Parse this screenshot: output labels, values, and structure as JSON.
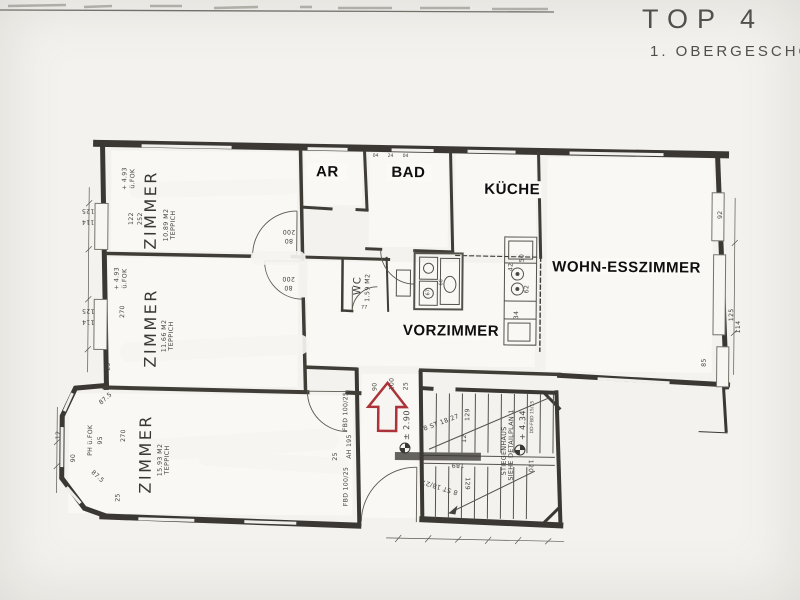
{
  "title": {
    "line1": "TOP 4",
    "line2": "1. OBERGESCHO"
  },
  "colors": {
    "paper": "#f3f2ee",
    "ink": "#3b3833",
    "label": "#0e0e0e",
    "red": "#ab3339"
  },
  "rooms": {
    "zimmer_top": {
      "label": "ZIMMER",
      "area": "10.89 M2",
      "floor": "TEPPICH"
    },
    "zimmer_mid": {
      "label": "ZIMMER",
      "area": "11.66 M2",
      "floor": "TEPPICH"
    },
    "zimmer_bottom": {
      "label": "ZIMMER",
      "area": "15.93 M2",
      "floor": "TEPPICH"
    },
    "ar": {
      "label": "AR"
    },
    "bad": {
      "label": "BAD"
    },
    "kueche": {
      "label": "KÜCHE"
    },
    "wohn_esszimmer": {
      "label": "WOHN-ESSZIMMER"
    },
    "vorzimmer": {
      "label": "VORZIMMER"
    },
    "wc": {
      "label": "WC",
      "area": "1.59 M2"
    }
  },
  "levels": {
    "room_level": "+ 4.93",
    "fok": "ü.FOK",
    "ph_fok": "PH ü.FOK",
    "stair_upper": "+ 4.34",
    "stair_landing": "± 2.90"
  },
  "stairs": {
    "name": "STIEGENHAUS",
    "note": "SIEHE DETAILPLAN 1",
    "flight_upper": "8 ST 18/27",
    "flight_lower": "8 ST 18/27",
    "slab_note": "DD-FBD 15/15",
    "width": "120",
    "run_upper": "129",
    "run_lower": "129",
    "run_small": "12",
    "length": "189"
  },
  "dims": {
    "left_125_a": "125",
    "left_114_a": "114",
    "left_122": "122",
    "left_252": "252",
    "left_270": "270",
    "left_125_b": "125",
    "left_114_b": "114",
    "mid_25": "25",
    "bottom_25": "25",
    "bay_875_a": "87.5",
    "bay_875_b": "87.5",
    "bay_95": "95",
    "bay_270": "270",
    "bay_12": "12",
    "bay_90": "90",
    "door_a_w": "80",
    "door_a_h": "200",
    "door_b_w": "80",
    "door_b_h": "200",
    "corr_fbd_a": "FBD 100/25",
    "corr_ah": "AH 195",
    "corr_fbd_b": "FBD 100/25",
    "corr_25": "25",
    "ent_90": "90",
    "ent_100": "100",
    "ent_25": "25",
    "kit_50": "50",
    "kit_42": "42",
    "kit_62": "62",
    "kit_34": "34",
    "right_92": "92",
    "right_125": "125",
    "right_114": "114",
    "right_85": "85",
    "wc_77": "77",
    "fix_60": "60",
    "fix_67": "67",
    "top_04_a": "04",
    "top_24": "24",
    "top_04_b": "04"
  }
}
